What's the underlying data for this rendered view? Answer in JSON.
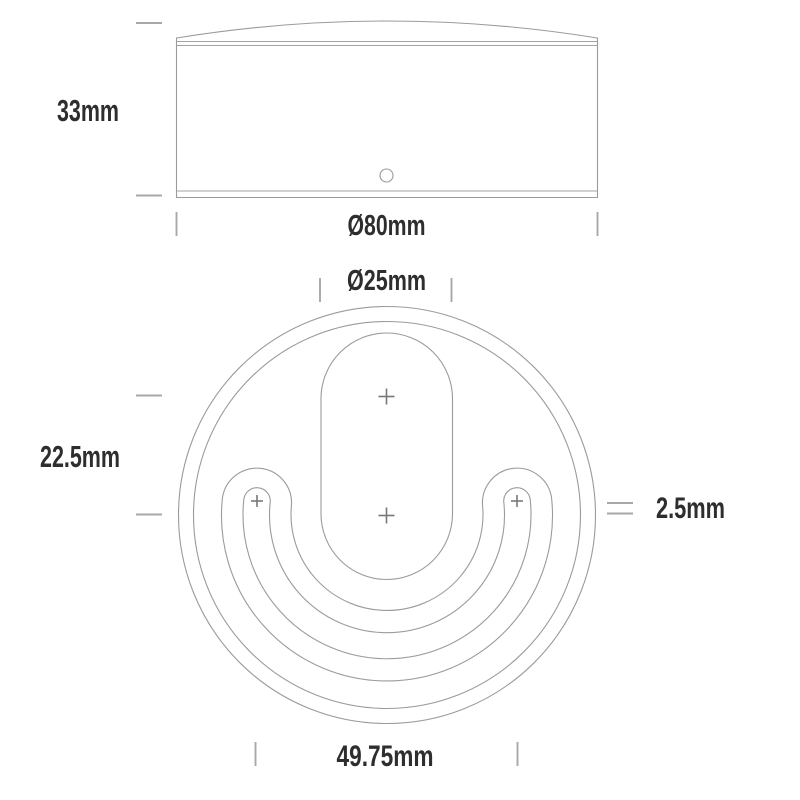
{
  "meta": {
    "type": "technical-dimension-drawing",
    "views": [
      "side-elevation",
      "top-plan-mounting"
    ]
  },
  "dimensions": {
    "side_view": [
      {
        "id": "body-height",
        "label": "33mm"
      },
      {
        "id": "outer-diameter",
        "label": "Ø80mm"
      }
    ],
    "top_view": [
      {
        "id": "pocket-width",
        "label": "Ø25mm"
      },
      {
        "id": "hole-to-center-offset",
        "label": "22.5mm"
      },
      {
        "id": "ring-gap",
        "label": "2.5mm"
      },
      {
        "id": "slot-center-span",
        "label": "49.75mm"
      }
    ]
  },
  "colors": {
    "background": "#ffffff",
    "outline": "#9b9b9b",
    "tick": "#a8a8a8",
    "crosshair": "#787878",
    "label_text": "#2e2e2e"
  }
}
